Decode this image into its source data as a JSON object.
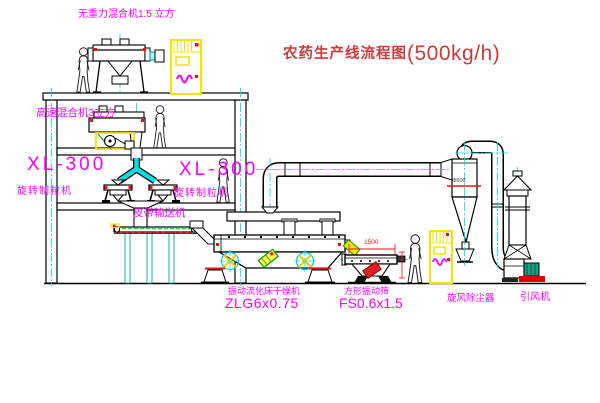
{
  "page": {
    "background": "#FFFFFF",
    "width": 600,
    "height": 403
  },
  "title": {
    "name_cn": "农药生产线流程图",
    "capacity": "(500kg/h)",
    "color": "#cc3b3b"
  },
  "labels": {
    "top_mixer": "无重力混合机1.5 立方",
    "floor2_mixer": "高速混合机3立方",
    "granulator_left_model": "XL-300",
    "granulator_left_name": "旋转制粒机",
    "granulator_right_model": "XL-300",
    "granulator_right_name": "旋转制粒机",
    "belt_conveyor": "皮带输送机",
    "dryer_name": "振动流化床干燥机",
    "dryer_model": "ZLG6x0.75",
    "screen_name": "方形振动筛",
    "screen_model": "FS0.6x1.5",
    "cyclone": "旋风除尘器",
    "fan": "引风机"
  },
  "dimensions": {
    "screen_length": "1500",
    "cyclone_diameter": "Φ600"
  },
  "palette": {
    "label_magenta": "#FF00FF",
    "annotation_red": "#EE1111",
    "centerline_cyan": "#00DCDC",
    "highlight_yellow": "#F6E400",
    "machine_green": "#00A000",
    "motor_teal": "#18A080",
    "line_black": "#000000"
  }
}
